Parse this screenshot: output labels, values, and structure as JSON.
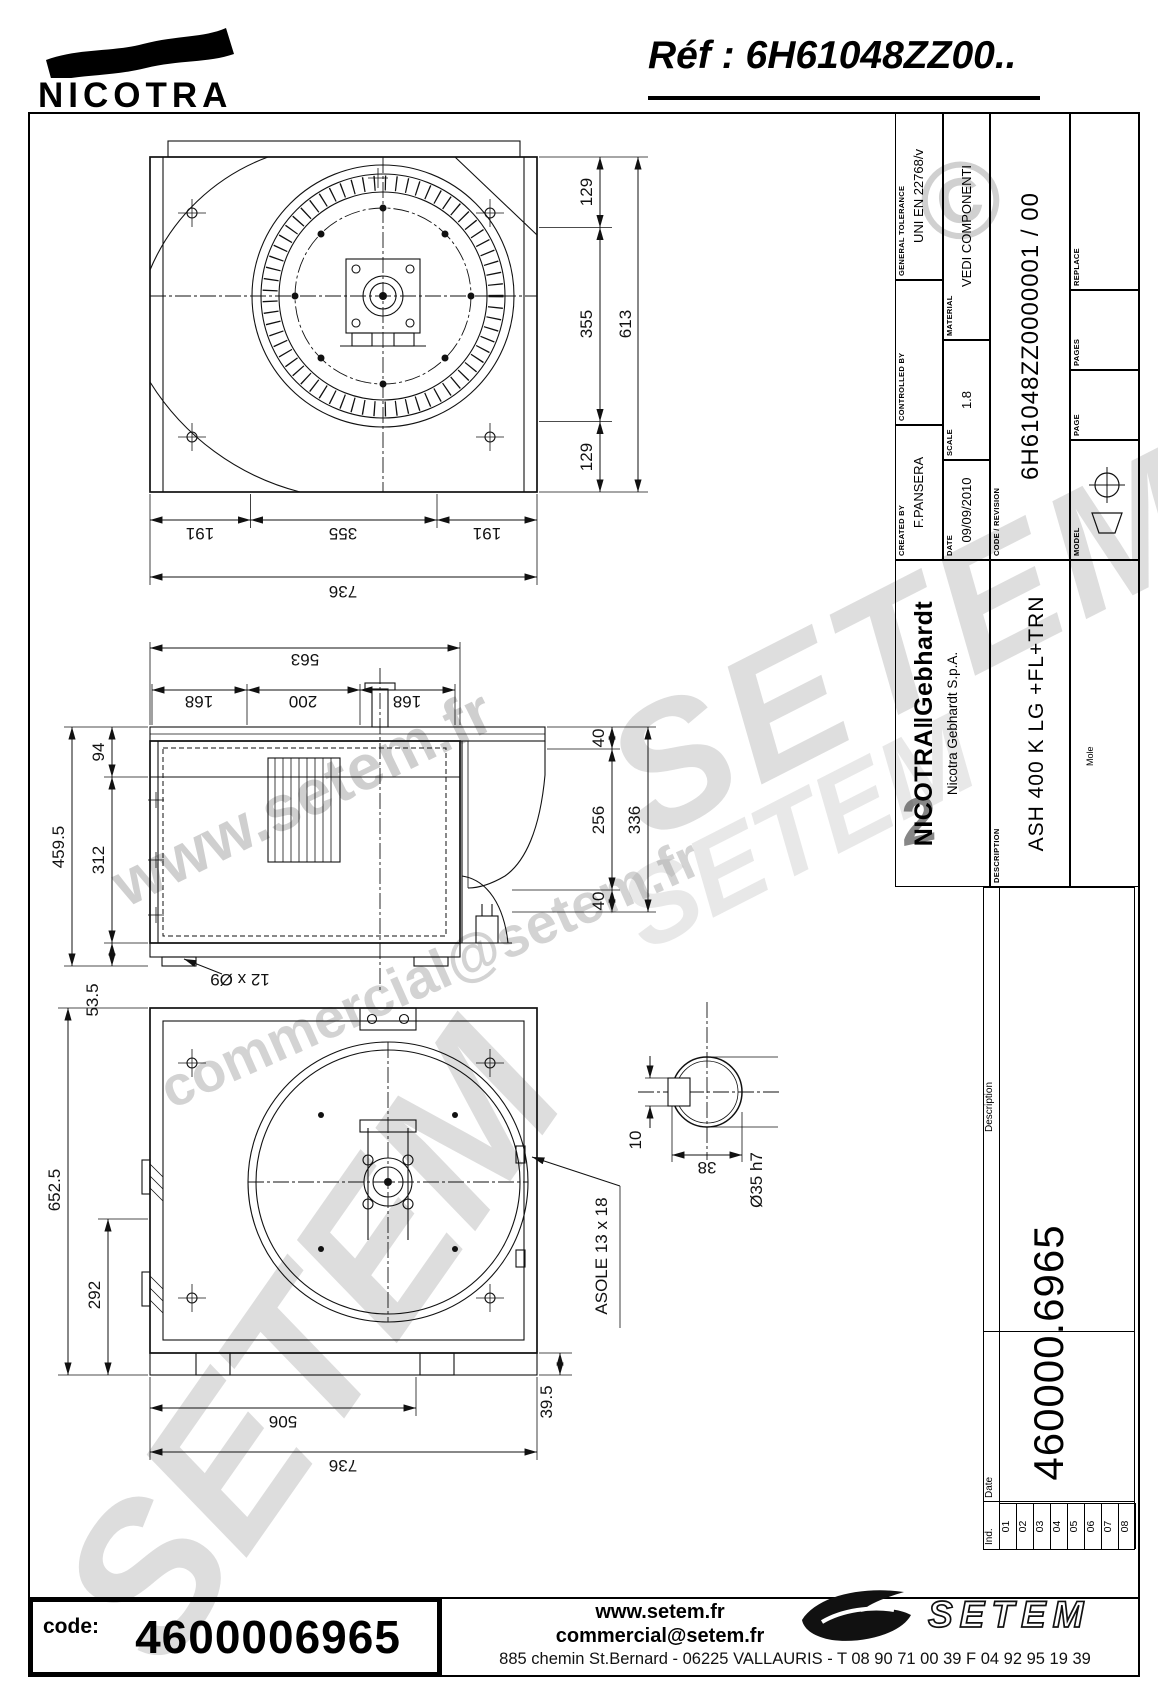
{
  "header": {
    "brand": "NICOTRA",
    "ref": "Réf : 6H61048ZZ00.."
  },
  "titleblock": {
    "created_by_label": "CREATED BY",
    "created_by": "F.PANSERA",
    "controlled_by_label": "CONTROLLED BY",
    "general_tolerance_label": "GENERAL TOLERANCE",
    "general_tolerance": "UNI EN 22768/v",
    "date_label": "DATE",
    "date": "09/09/2010",
    "scale_label": "SCALE",
    "scale": "1.8",
    "material_label": "MATERIAL",
    "material": "VEDI COMPONENTI",
    "code_revision_label": "CODE / REVISION",
    "code_revision": "6H61048ZZ0000001 / 00",
    "model_label": "MODEL",
    "page_label": "PAGE",
    "pages_label": "PAGES",
    "replace_label": "REPLACE",
    "company_logo": "NICOTRA‖Gebhardt",
    "company_name": "Nicotra Gebhardt S.p.A.",
    "description_label": "DESCRIPTION",
    "description": "ASH 400 K  LG +FL+TRN",
    "mole_label": "Mole",
    "item_code": "460000.6965"
  },
  "revision_table": {
    "ind_label": "Ind.",
    "date_label": "Date",
    "description_label": "Description",
    "rows": [
      "01",
      "02",
      "03",
      "04",
      "05",
      "06",
      "07",
      "08"
    ]
  },
  "dims": {
    "front_right": [
      "129",
      "355",
      "129"
    ],
    "front_height": "613",
    "front_bottom": [
      "191",
      "355",
      "191"
    ],
    "front_width": "736",
    "side_depth": "563",
    "side_top": [
      "168",
      "200",
      "168"
    ],
    "side_left": [
      "94",
      "312",
      "53.5"
    ],
    "side_height": "459.5",
    "side_right": [
      "40",
      "256",
      "40"
    ],
    "side_inlet": "336",
    "side_hole_label": "12 x Ø9",
    "back_height": "652.5",
    "back_offset": "292",
    "back_bottom": [
      "506",
      "736"
    ],
    "back_lip": "39.5",
    "back_slot_label": "ASOLE 13 x 18",
    "shaft_key": "10",
    "shaft_across": "38",
    "shaft_dia": "Ø35 h7"
  },
  "footer": {
    "code_label": "code:",
    "code_value": "4600006965",
    "website": "www.setem.fr",
    "email": "commercial@setem.fr",
    "address": "885 chemin St.Bernard - 06225 VALLAURIS - T 08 90 71 00 39  F 04 92 95 19 39",
    "setem_logo": "SETEM"
  },
  "watermarks": {
    "wm1": "www.setem.fr",
    "wm2": "SETEM",
    "wm3": "commercial@setem.fr",
    "wm4": "SETEM",
    "wm6": "SETEM",
    "copyright": "©",
    "wm_digit": "2"
  }
}
